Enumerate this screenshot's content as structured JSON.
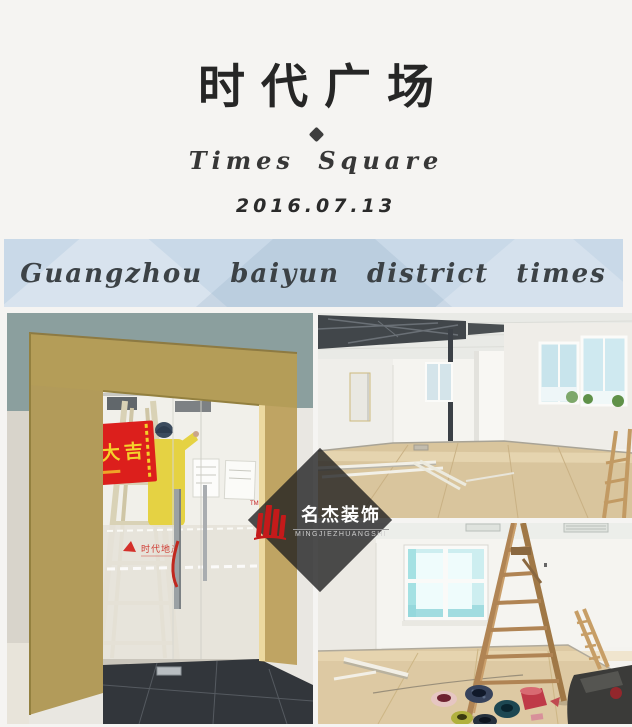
{
  "page": {
    "background_color": "#f5f4f2"
  },
  "header": {
    "title": "时代广场",
    "subtitle": "Times Square",
    "date": "2016.07.13"
  },
  "banner": {
    "text": "Guangzhou baiyun district times square",
    "background_color": "#c9d9e8"
  },
  "watermark": {
    "brand_cn": "名杰装饰",
    "brand_en": "MINGJIEZHUANGSHI",
    "tm": "TM",
    "logo_color": "#c41a1a"
  },
  "photos": {
    "door": {
      "opening_banner_text": "開工大吉",
      "glass_logo_text": "时代地产"
    }
  }
}
